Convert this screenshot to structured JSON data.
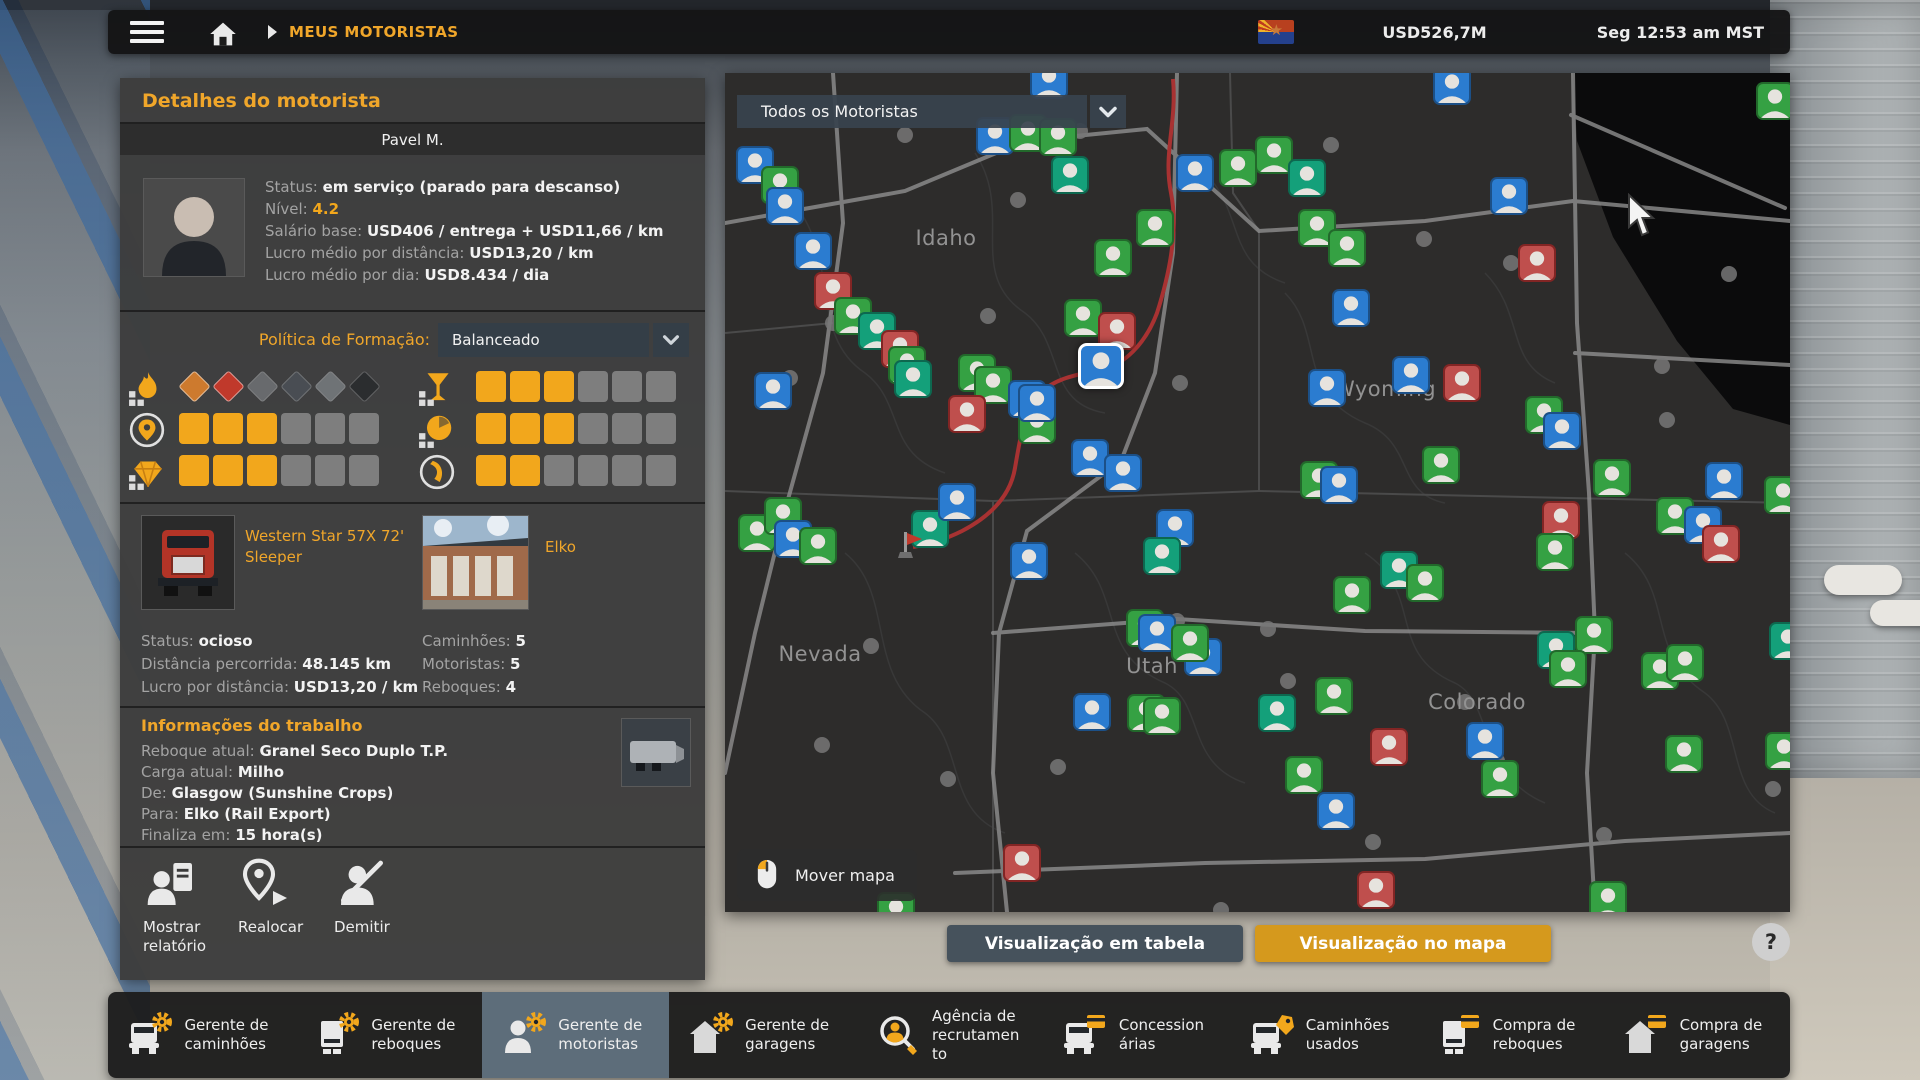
{
  "top_bar": {
    "breadcrumb": "MEUS MOTORISTAS",
    "money": "USD526,7M",
    "time": "Seg 12:53 am MST"
  },
  "driver_panel": {
    "title": "Detalhes do motorista",
    "name": "Pavel M.",
    "info": [
      {
        "l": "Status:",
        "v": "em serviço (parado para descanso)"
      },
      {
        "l": "Nível:",
        "v": "4.2",
        "c": "gold"
      },
      {
        "l": "Salário base:",
        "v": "USD406 / entrega + USD11,66 / km"
      },
      {
        "l": "Lucro médio por distância:",
        "v": "USD13,20 / km"
      },
      {
        "l": "Lucro médio por dia:",
        "v": "USD8.434 / dia"
      }
    ],
    "policy_label": "Política de Formação:",
    "policy_value": "Balanceado",
    "skills": [
      {
        "slot": "l0",
        "icon": "adr",
        "placards": [
          "#cd7a2e",
          "#c0392b",
          "#9aa0a4",
          "#57606a",
          "#aab2b8",
          "#15181c"
        ],
        "lit": 2
      },
      {
        "slot": "l1",
        "icon": "pin",
        "level": 3,
        "max": 6
      },
      {
        "slot": "l2",
        "icon": "diamond",
        "level": 3,
        "max": 6
      },
      {
        "slot": "r0",
        "icon": "glass",
        "level": 3,
        "max": 6
      },
      {
        "slot": "r1",
        "icon": "clock",
        "level": 3,
        "max": 6
      },
      {
        "slot": "r2",
        "icon": "pedal",
        "level": 2,
        "max": 6
      }
    ],
    "truck": {
      "name": "Western Star 57X 72' Sleeper",
      "stats": [
        {
          "l": "Status:",
          "v": "ocioso"
        },
        {
          "l": "Distância percorrida:",
          "v": "48.145 km"
        },
        {
          "l": "Lucro por distância:",
          "v": "USD13,20 / km"
        }
      ]
    },
    "garage": {
      "name": "Elko",
      "stats": [
        {
          "l": "Caminhões:",
          "v": "5"
        },
        {
          "l": "Motoristas:",
          "v": "5"
        },
        {
          "l": "Reboques:",
          "v": "4"
        }
      ]
    },
    "job": {
      "title": "Informações do trabalho",
      "lines": [
        {
          "l": "Reboque atual:",
          "v": "Granel Seco Duplo T.P."
        },
        {
          "l": "Carga atual:",
          "v": "Milho"
        },
        {
          "l": "De:",
          "v": "Glasgow (Sunshine Crops)"
        },
        {
          "l": "Para:",
          "v": "Elko (Rail Export)"
        },
        {
          "l": "Finaliza em:",
          "v": "15 hora(s)"
        }
      ]
    },
    "actions": [
      "Mostrar relatório",
      "Realocar",
      "Demitir"
    ]
  },
  "map": {
    "filter": "Todos os Motoristas",
    "pan_hint": "Mover mapa",
    "states": [
      {
        "n": "Idaho",
        "x": 221,
        "y": 165
      },
      {
        "n": "Wyoming",
        "x": 660,
        "y": 316
      },
      {
        "n": "Nevada",
        "x": 95,
        "y": 581
      },
      {
        "n": "Utah",
        "x": 427,
        "y": 593
      },
      {
        "n": "Colorado",
        "x": 752,
        "y": 629
      }
    ],
    "markers": [
      [
        324,
        7,
        "b"
      ],
      [
        727,
        13,
        "b"
      ],
      [
        30,
        92,
        "b"
      ],
      [
        55,
        112,
        "g"
      ],
      [
        60,
        133,
        "b"
      ],
      [
        270,
        63,
        "b"
      ],
      [
        303,
        60,
        "g"
      ],
      [
        333,
        64,
        "g"
      ],
      [
        345,
        102,
        "t"
      ],
      [
        470,
        100,
        "b"
      ],
      [
        513,
        95,
        "g"
      ],
      [
        430,
        155,
        "g"
      ],
      [
        388,
        185,
        "g"
      ],
      [
        88,
        178,
        "b"
      ],
      [
        108,
        218,
        "r"
      ],
      [
        128,
        243,
        "g"
      ],
      [
        152,
        258,
        "t"
      ],
      [
        175,
        276,
        "r"
      ],
      [
        182,
        292,
        "g"
      ],
      [
        188,
        306,
        "t"
      ],
      [
        48,
        318,
        "b"
      ],
      [
        252,
        300,
        "g"
      ],
      [
        268,
        312,
        "g"
      ],
      [
        302,
        326,
        "b"
      ],
      [
        242,
        341,
        "r"
      ],
      [
        312,
        352,
        "g"
      ],
      [
        358,
        245,
        "g"
      ],
      [
        392,
        258,
        "r"
      ],
      [
        312,
        330,
        "b"
      ],
      [
        365,
        385,
        "b"
      ],
      [
        398,
        400,
        "b"
      ],
      [
        376,
        293,
        "s"
      ],
      [
        549,
        82,
        "g"
      ],
      [
        582,
        105,
        "t"
      ],
      [
        592,
        155,
        "g"
      ],
      [
        622,
        175,
        "g"
      ],
      [
        626,
        235,
        "b"
      ],
      [
        784,
        123,
        "b"
      ],
      [
        812,
        190,
        "r"
      ],
      [
        686,
        302,
        "b"
      ],
      [
        737,
        310,
        "r"
      ],
      [
        602,
        315,
        "b"
      ],
      [
        819,
        342,
        "g"
      ],
      [
        837,
        358,
        "b"
      ],
      [
        716,
        392,
        "g"
      ],
      [
        594,
        407,
        "g"
      ],
      [
        614,
        412,
        "b"
      ],
      [
        887,
        405,
        "g"
      ],
      [
        999,
        408,
        "b"
      ],
      [
        1050,
        28,
        "g"
      ],
      [
        1058,
        422,
        "g"
      ],
      [
        1063,
        568,
        "t"
      ],
      [
        1059,
        678,
        "g"
      ],
      [
        32,
        460,
        "g"
      ],
      [
        58,
        443,
        "g"
      ],
      [
        68,
        466,
        "b"
      ],
      [
        93,
        473,
        "g"
      ],
      [
        205,
        456,
        "t"
      ],
      [
        232,
        429,
        "b"
      ],
      [
        304,
        488,
        "b"
      ],
      [
        450,
        455,
        "b"
      ],
      [
        437,
        483,
        "t"
      ],
      [
        420,
        555,
        "g"
      ],
      [
        432,
        560,
        "b"
      ],
      [
        478,
        584,
        "b"
      ],
      [
        465,
        570,
        "g"
      ],
      [
        367,
        639,
        "b"
      ],
      [
        421,
        640,
        "g"
      ],
      [
        437,
        643,
        "g"
      ],
      [
        297,
        790,
        "r"
      ],
      [
        171,
        838,
        "g"
      ],
      [
        836,
        447,
        "r"
      ],
      [
        830,
        479,
        "g"
      ],
      [
        950,
        443,
        "g"
      ],
      [
        978,
        452,
        "b"
      ],
      [
        996,
        471,
        "r"
      ],
      [
        674,
        497,
        "t"
      ],
      [
        700,
        510,
        "g"
      ],
      [
        627,
        522,
        "g"
      ],
      [
        831,
        577,
        "t"
      ],
      [
        869,
        562,
        "g"
      ],
      [
        843,
        596,
        "g"
      ],
      [
        935,
        598,
        "g"
      ],
      [
        960,
        590,
        "g"
      ],
      [
        609,
        623,
        "g"
      ],
      [
        552,
        640,
        "t"
      ],
      [
        664,
        674,
        "r"
      ],
      [
        760,
        668,
        "b"
      ],
      [
        775,
        706,
        "g"
      ],
      [
        579,
        702,
        "g"
      ],
      [
        611,
        738,
        "b"
      ],
      [
        959,
        681,
        "g"
      ],
      [
        651,
        817,
        "r"
      ],
      [
        883,
        827,
        "g"
      ]
    ],
    "marker_colors": {
      "g": "#35a143",
      "t": "#14a07a",
      "b": "#2b7cd0",
      "r": "#bf4f4d",
      "selected_border": "#ffffff"
    }
  },
  "buttons": {
    "table": "Visualização em tabela",
    "map": "Visualização no mapa",
    "help": "?"
  },
  "nav": {
    "items": [
      {
        "label": "Gerente de caminhões",
        "icon": "truck-mgr",
        "active": false
      },
      {
        "label": "Gerente de reboques",
        "icon": "trailer-mgr",
        "active": false
      },
      {
        "label": "Gerente de motoristas",
        "icon": "driver-mgr",
        "active": true
      },
      {
        "label": "Gerente de garagens",
        "icon": "garage-mgr",
        "active": false
      },
      {
        "label": "Agência de recrutamento",
        "icon": "recruit",
        "active": false
      },
      {
        "label": "Concessionárias",
        "icon": "dealer",
        "active": false
      },
      {
        "label": "Caminhões usados",
        "icon": "used-trucks",
        "active": false
      },
      {
        "label": "Compra de reboques",
        "icon": "buy-trailer",
        "active": false
      },
      {
        "label": "Compra de garagens",
        "icon": "buy-garage",
        "active": false
      }
    ]
  },
  "colors": {
    "accent_gold": "#f2a71c",
    "header_gold": "#f0a62a",
    "slate": "#46525c",
    "gold_button": "#d5991d",
    "panel": "#3d3d3d",
    "map_bg": "#2d2c2b"
  }
}
